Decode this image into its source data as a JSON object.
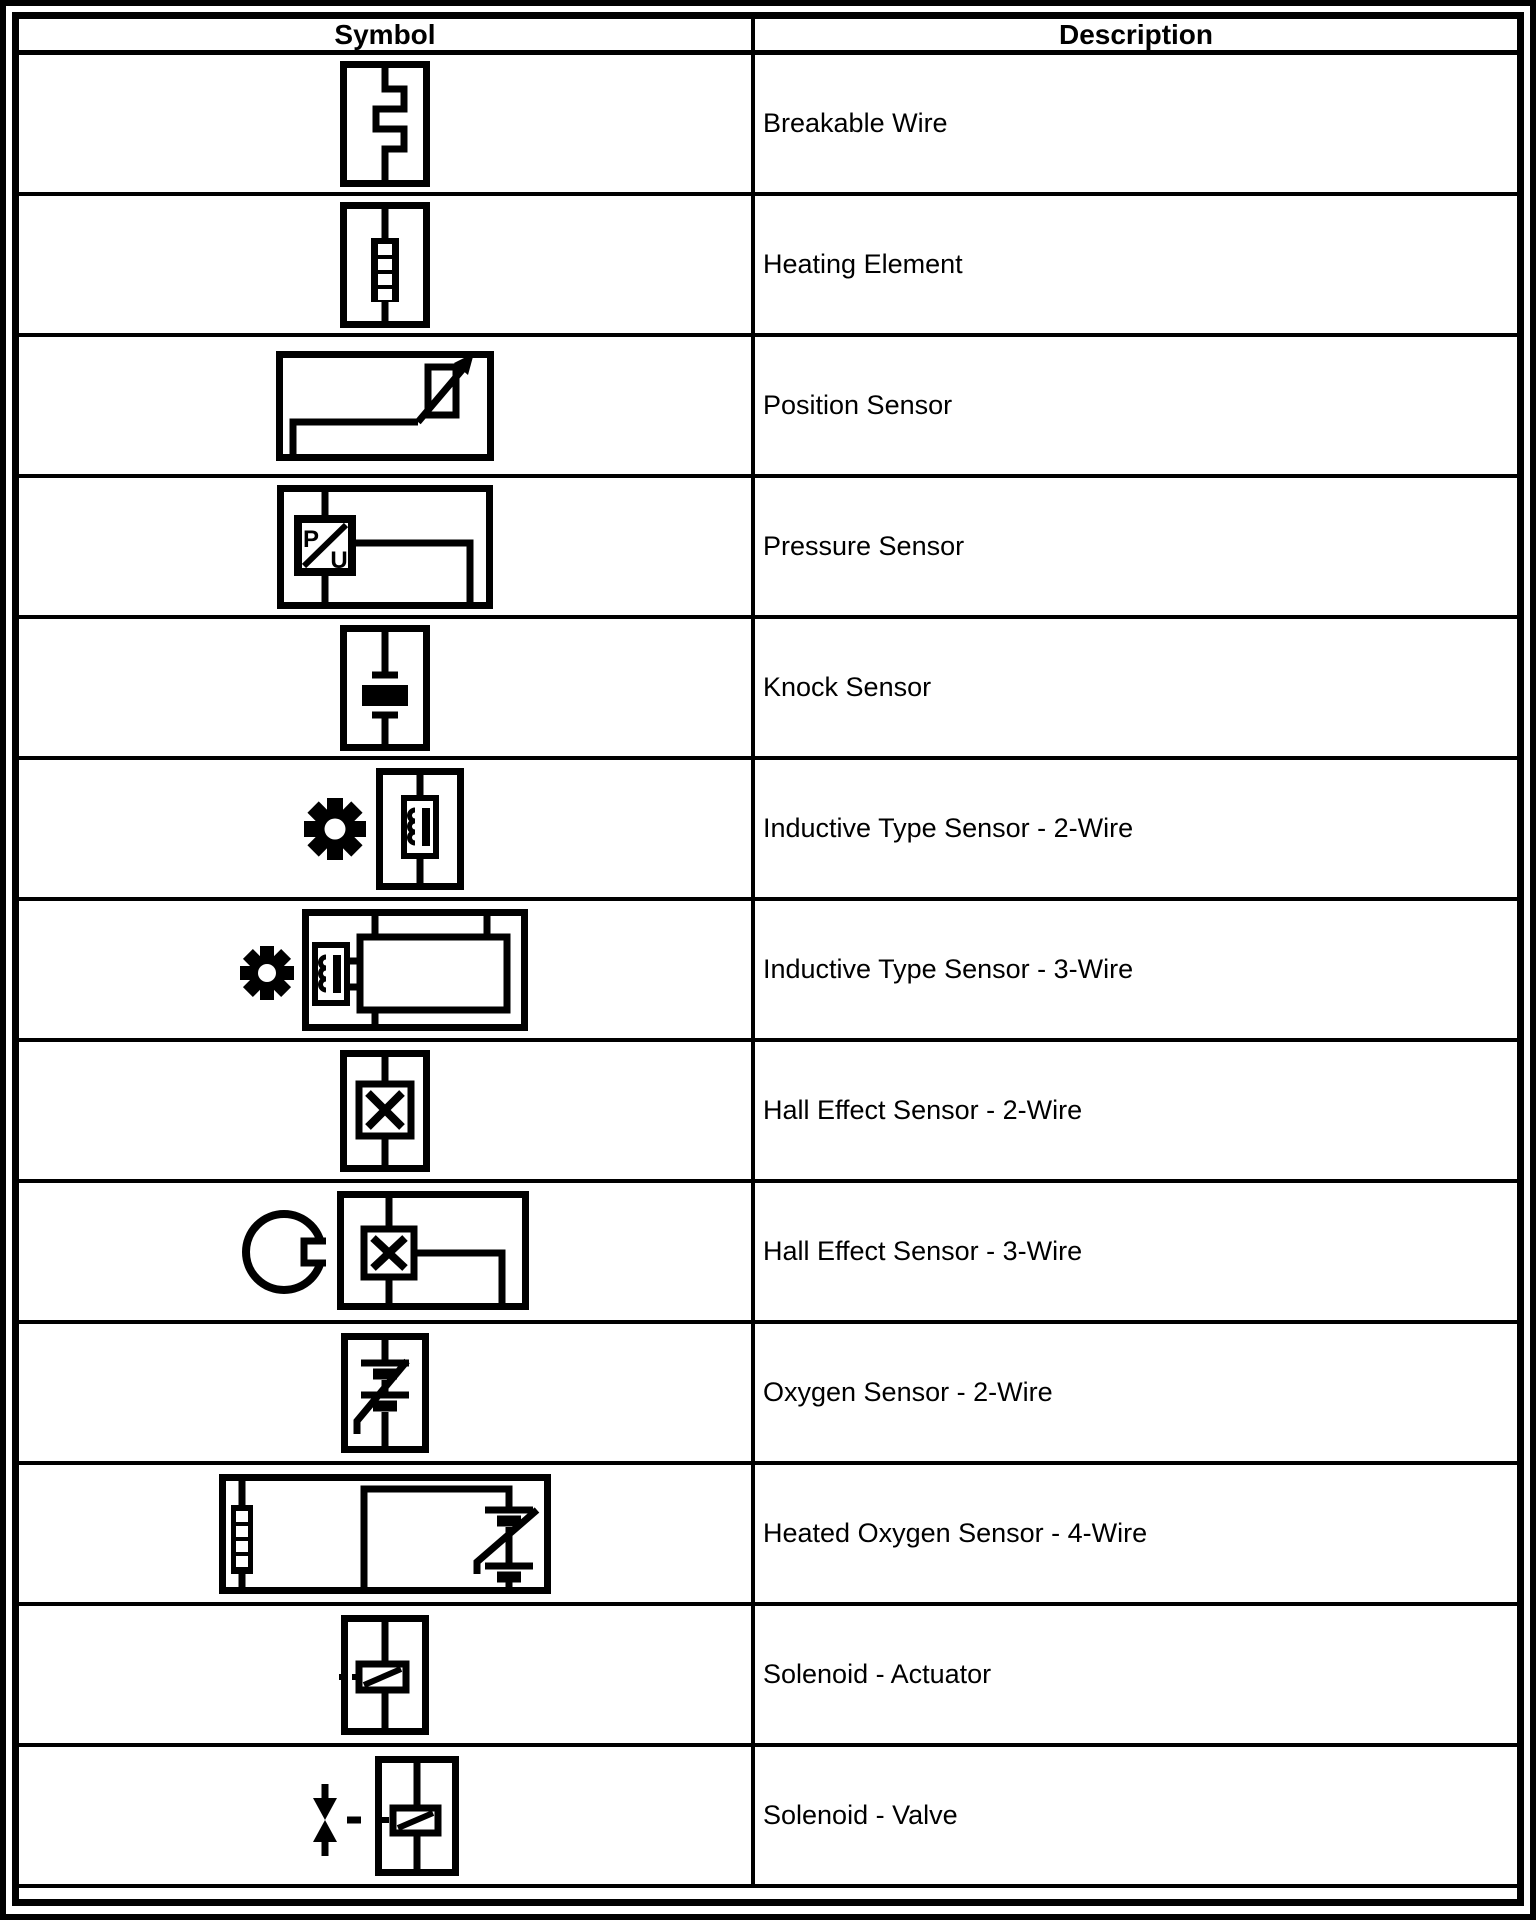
{
  "table": {
    "headers": {
      "symbol": "Symbol",
      "description": "Description"
    },
    "rows": [
      {
        "name": "breakable-wire",
        "description": "Breakable Wire"
      },
      {
        "name": "heating-element",
        "description": "Heating Element"
      },
      {
        "name": "position-sensor",
        "description": "Position Sensor"
      },
      {
        "name": "pressure-sensor",
        "description": "Pressure Sensor",
        "p_label": "P",
        "u_label": "U"
      },
      {
        "name": "knock-sensor",
        "description": "Knock Sensor"
      },
      {
        "name": "inductive-type-sensor-2-wire",
        "description": "Inductive Type Sensor - 2-Wire"
      },
      {
        "name": "inductive-type-sensor-3-wire",
        "description": "Inductive Type Sensor - 3-Wire"
      },
      {
        "name": "hall-effect-sensor-2-wire",
        "description": "Hall Effect Sensor - 2-Wire"
      },
      {
        "name": "hall-effect-sensor-3-wire",
        "description": "Hall Effect Sensor - 3-Wire"
      },
      {
        "name": "oxygen-sensor-2-wire",
        "description": "Oxygen Sensor - 2-Wire"
      },
      {
        "name": "heated-oxygen-sensor-4-wire",
        "description": "Heated Oxygen Sensor - 4-Wire"
      },
      {
        "name": "solenoid-actuator",
        "description": "Solenoid - Actuator"
      },
      {
        "name": "solenoid-valve",
        "description": "Solenoid - Valve"
      }
    ],
    "colors": {
      "ink": "#000000",
      "paper": "#ffffff"
    }
  }
}
